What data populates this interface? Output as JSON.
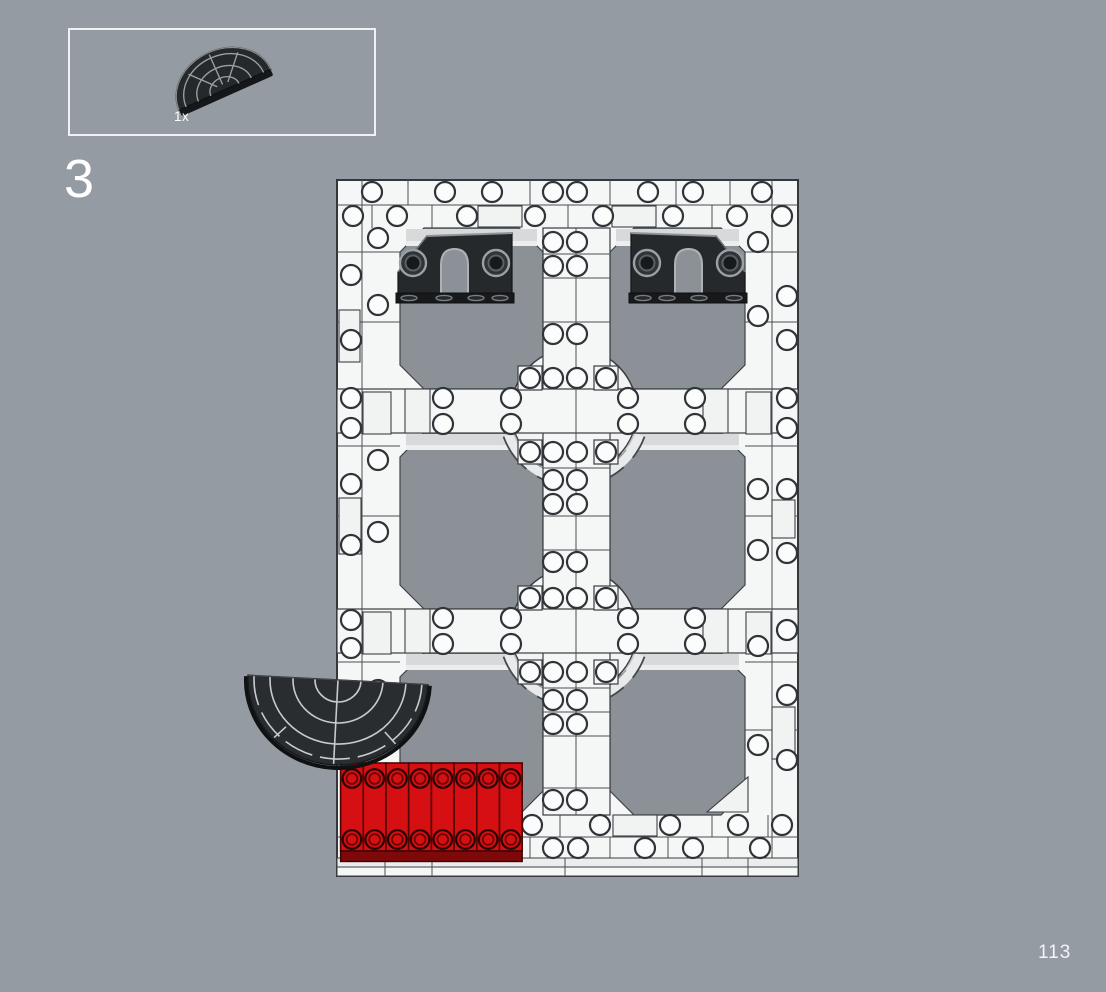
{
  "page": {
    "step_number": "3",
    "page_number": "113",
    "background_color": "#959ba2"
  },
  "parts_callout": {
    "quantity_label": "1x",
    "part_name": "black curved fan plate (semicircular tile)"
  },
  "assembly": {
    "description": "white brick frame with six octagonal openings",
    "grid_openings": 6,
    "black_arch_bricks": 2,
    "red_plates": 8,
    "fan_plates": 1
  },
  "colors": {
    "frame_white": "#f5f6f6",
    "opening_gray": "#8b9196",
    "black_part": "#26292c",
    "fan_plate": "#2a2d30",
    "red_brick": "#d50f12",
    "red_brick_dark": "#7d090b",
    "highlight": "#d7d9da"
  }
}
